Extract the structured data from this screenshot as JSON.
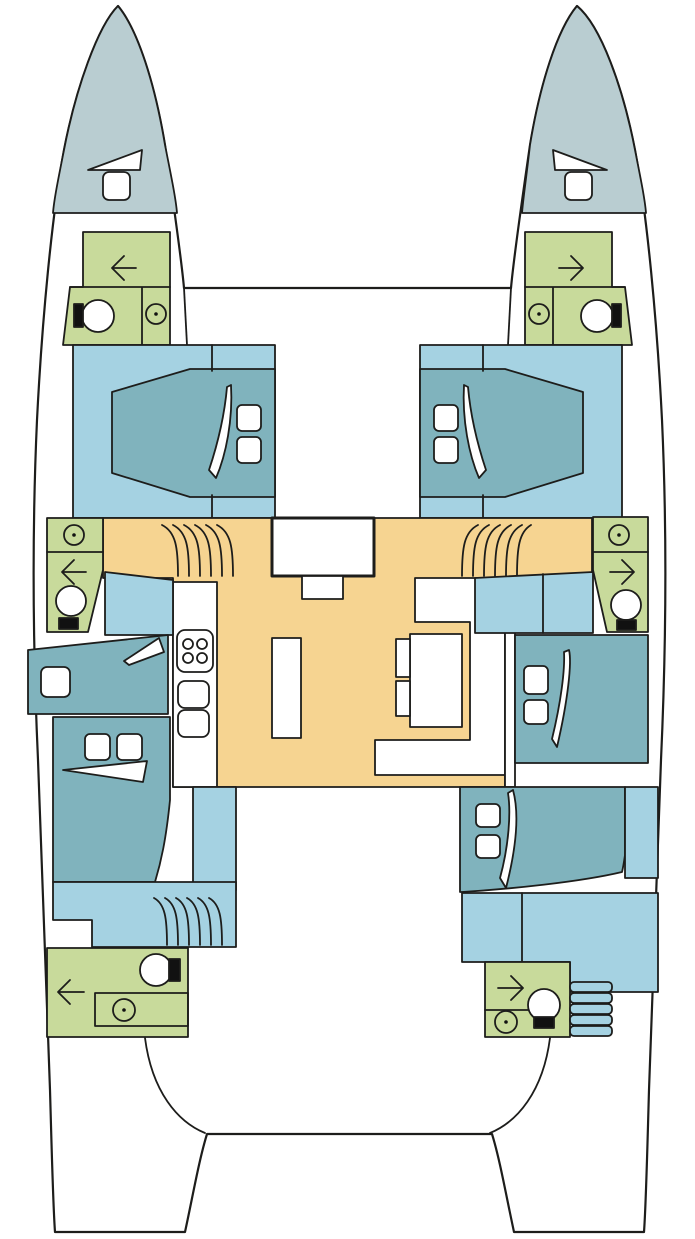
{
  "title": "catamaran-interior-deck-plan",
  "colors": {
    "line": "#1d1d1b",
    "white": "#ffffff",
    "bow": "#b9cdd1",
    "bath_green": "#c8da9b",
    "floor_blue": "#a5d2e2",
    "bed_teal": "#80b3bd",
    "salon_sand": "#f6d491",
    "black_fixture": "#111111"
  },
  "plan": {
    "vessel_type": "catamaran",
    "orientation": "bow-up",
    "decks": {
      "bow_port": {
        "name": "port bow locker",
        "fixtures": [
          "deck-hatch",
          "anchor-wedge"
        ]
      },
      "bow_starboard": {
        "name": "starboard bow locker",
        "fixtures": [
          "deck-hatch",
          "anchor-wedge"
        ]
      },
      "forepeak_head_port": {
        "name": "port forepeak crew head",
        "fixtures": [
          "toilet",
          "washbasin",
          "door-arrow-left"
        ]
      },
      "forepeak_head_starboard": {
        "name": "starboard forepeak crew head",
        "fixtures": [
          "toilet",
          "washbasin",
          "door-arrow-right"
        ]
      },
      "cabin_forward_port": {
        "name": "port forward cabin",
        "fixtures": [
          "double-bed",
          "pillow",
          "pillow",
          "duvet-fold"
        ]
      },
      "cabin_forward_starboard": {
        "name": "starboard forward cabin",
        "fixtures": [
          "double-bed",
          "pillow",
          "pillow",
          "duvet-fold"
        ]
      },
      "head_mid_port": {
        "name": "port mid head",
        "fixtures": [
          "washbasin",
          "toilet",
          "door-arrow-left"
        ]
      },
      "head_mid_starboard": {
        "name": "starboard mid head",
        "fixtures": [
          "washbasin",
          "toilet",
          "door-arrow-right"
        ]
      },
      "salon": {
        "name": "salon and galley",
        "fixtures": [
          "entry-door",
          "companionway-steps-port",
          "companionway-steps-starboard",
          "stove-4-burner",
          "double-sink",
          "island-counter",
          "dinette-table",
          "dinette-bench",
          "stool",
          "stool"
        ]
      },
      "cabin_mid_port": {
        "name": "port single berth",
        "fixtures": [
          "single-bed",
          "pillow",
          "duvet-fold"
        ]
      },
      "cabin_aft_port": {
        "name": "port aft cabin",
        "fixtures": [
          "double-bed",
          "pillow",
          "pillow",
          "duvet-fold",
          "steps"
        ]
      },
      "cabin_mid_starboard": {
        "name": "starboard mid cabin",
        "fixtures": [
          "double-bed",
          "pillow",
          "pillow",
          "duvet-fold"
        ]
      },
      "cabin_aft_starboard": {
        "name": "starboard aft cabin",
        "fixtures": [
          "double-bed",
          "pillow",
          "pillow",
          "duvet-fold",
          "steps"
        ]
      },
      "head_aft_port": {
        "name": "port aft head",
        "fixtures": [
          "toilet",
          "washbasin",
          "door-arrow-left"
        ]
      },
      "head_aft_starboard": {
        "name": "starboard aft head",
        "fixtures": [
          "toilet",
          "washbasin",
          "door-arrow-right"
        ]
      },
      "cockpit": {
        "name": "aft cockpit and transom"
      }
    },
    "legend_icons": [
      "toilet-icon",
      "washbasin-icon",
      "stove-icon",
      "sink-icon",
      "bed-icon",
      "pillow-icon",
      "steps-icon",
      "hatch-icon",
      "door-arrow-icon"
    ]
  }
}
